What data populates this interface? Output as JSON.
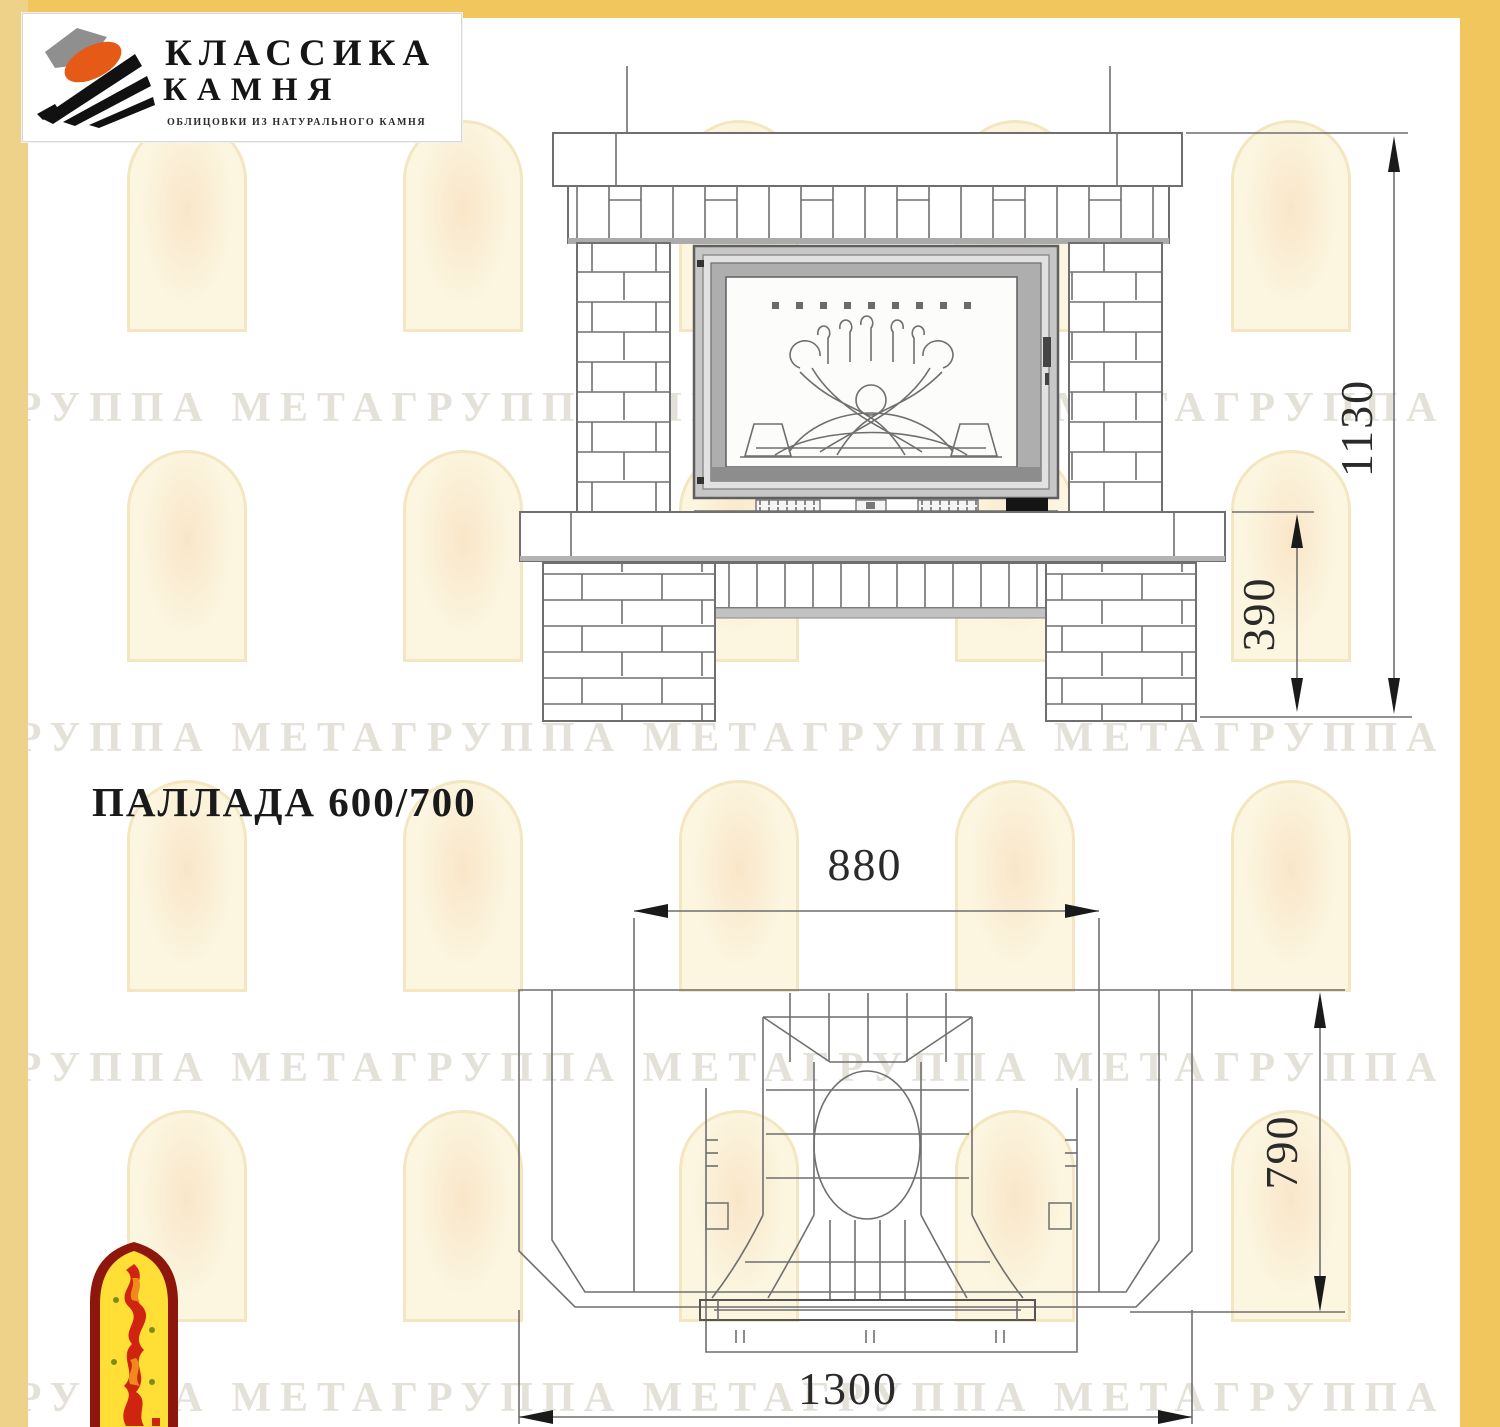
{
  "logo": {
    "title_line1": "КЛАССИКА",
    "title_line2": "КАМНЯ",
    "subtitle": "ОБЛИЦОВКИ ИЗ НАТУРАЛЬНОГО КАМНЯ",
    "colors": {
      "gray": "#8f8f8f",
      "orange": "#e55a17",
      "black": "#111111"
    }
  },
  "title": "ПАЛЛАДА 600/700",
  "watermark": {
    "text": "ГРУППА МЕТАГРУППА МЕТАГРУППА МЕТАГРУППА МЕТА",
    "arch_border_color": "#f3e6c0",
    "text_color": "rgba(165,155,130,0.30)"
  },
  "front_view": {
    "dim_total_height": "1130",
    "dim_base_height": "390"
  },
  "plan_view": {
    "dim_firebox_width": "880",
    "dim_depth": "790",
    "dim_total_width": "1300"
  },
  "page": {
    "border_color": "#f1c65c"
  },
  "emblem": {
    "border_color": "#8e170d",
    "fill_color": "#ffdf35",
    "flame_color": "#cf2410"
  }
}
